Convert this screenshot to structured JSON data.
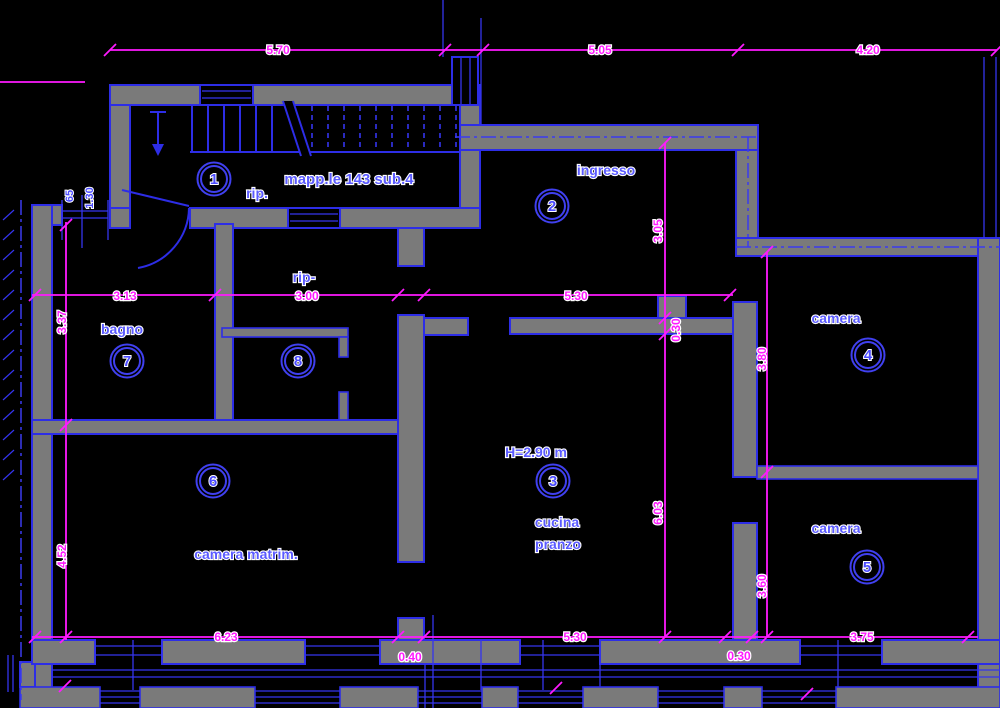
{
  "colors": {
    "background": "#000000",
    "wall_fill": "#7a7a7a",
    "line_blue": "#2d2de6",
    "label_blue": "#5a5aff",
    "dimension_magenta": "#ff1aff"
  },
  "annotations": {
    "parcel": "mapp.le 143 sub.4",
    "storage_top": "rip.",
    "storage_mid": "rip-",
    "ceiling_height": "H=2.90 m"
  },
  "rooms": {
    "r1": {
      "number": "1"
    },
    "r2": {
      "number": "2",
      "label": "ingresso"
    },
    "r3": {
      "number": "3",
      "label_line1": "cucina",
      "label_line2": "pranzo"
    },
    "r4": {
      "number": "4",
      "label": "camera"
    },
    "r5": {
      "number": "5",
      "label": "camera"
    },
    "r6": {
      "number": "6",
      "label": "camera matrim."
    },
    "r7": {
      "number": "7",
      "label": "bagno"
    },
    "r8": {
      "number": "8"
    }
  },
  "dimensions": {
    "top": [
      "5.70",
      "5.05",
      "4.20"
    ],
    "middle": [
      "3.13",
      "3.00",
      "5.30"
    ],
    "bottom": [
      "6.23",
      "0.40",
      "5.30",
      "0.30",
      "3.75"
    ],
    "left": [
      "3.37",
      "4.52"
    ],
    "center_vertical": [
      "3.05",
      "0.30",
      "6.03"
    ],
    "right_vertical": [
      "3.80",
      "3.60"
    ],
    "window": [
      "65",
      "1.30"
    ]
  }
}
